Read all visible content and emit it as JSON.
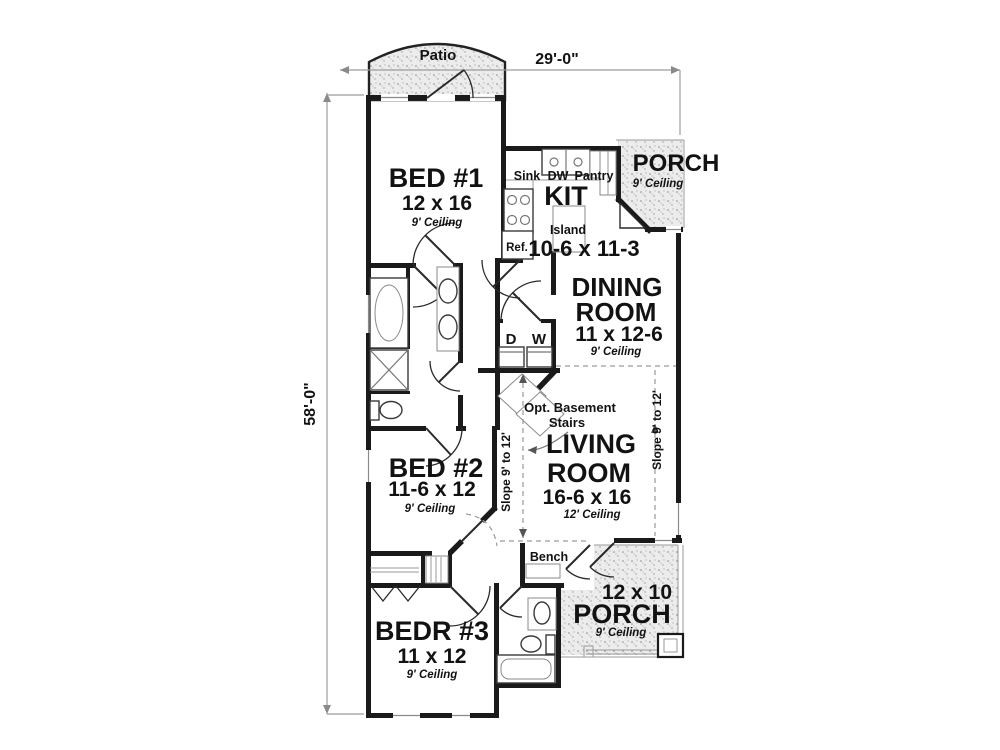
{
  "plan": {
    "dim_width": "29'-0\"",
    "dim_height": "58'-0\"",
    "patio_label": "Patio"
  },
  "rooms": {
    "bed1": {
      "name": "BED #1",
      "size": "12 x 16",
      "ceiling": "9' Ceiling"
    },
    "kitchen": {
      "name": "KIT",
      "size": "10-6 x 11-3",
      "island": "Island",
      "sink": "Sink",
      "dishwasher": "DW",
      "pantry": "Pantry",
      "fridge": "Ref."
    },
    "porch_top": {
      "name": "PORCH",
      "ceiling": "9' Ceiling"
    },
    "dining": {
      "name_line1": "DINING",
      "name_line2": "ROOM",
      "size": "11 x 12-6",
      "ceiling": "9' Ceiling"
    },
    "living": {
      "name_line1": "LIVING",
      "name_line2": "ROOM",
      "size": "16-6 x 16",
      "ceiling": "12' Ceiling"
    },
    "bed2": {
      "name": "BED #2",
      "size": "11-6 x 12",
      "ceiling": "9' Ceiling"
    },
    "bed3": {
      "name": "BEDR #3",
      "size": "11 x 12",
      "ceiling": "9' Ceiling"
    },
    "porch_bottom": {
      "name": "PORCH",
      "size": "12 x 10",
      "ceiling": "9' Ceiling"
    }
  },
  "annotations": {
    "dryer": "D",
    "washer": "W",
    "stairs_line1": "Opt. Basement",
    "stairs_line2": "Stairs",
    "bench": "Bench",
    "slope_left": "Slope 9' to 12'",
    "slope_right": "Slope 9' to 12'"
  },
  "colors": {
    "wall": "#1a1a1a",
    "stipple_background": "#ececec",
    "stipple_dot": "#8f8f8f",
    "dimension_line": "#9c9c9c",
    "paper": "#ffffff"
  }
}
